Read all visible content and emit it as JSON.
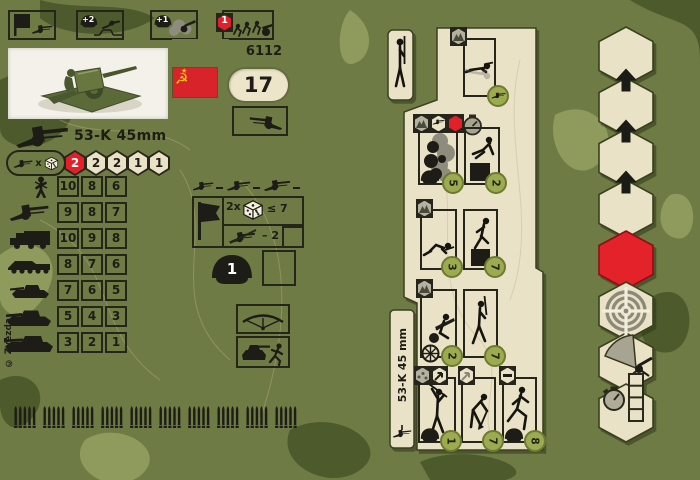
{
  "palette": {
    "camo_base": "#6e7b44",
    "camo_dark": "#4d5a2b",
    "camo_light": "#8f9b5c",
    "card": "#e9e2c6",
    "ink": "#26251c",
    "red": "#e3202a",
    "order_green": "#9cab4f",
    "flag_red": "#d8232a",
    "flag_gold": "#f6c90e"
  },
  "left_card": {
    "code": "6112",
    "points": "17",
    "title": "53-K 45mm",
    "top_icons": [
      {
        "name": "deployment-flag-gun",
        "label": ""
      },
      {
        "name": "infantry-support-bonus",
        "label": "+2"
      },
      {
        "name": "concealment-bonus",
        "label": "+1"
      },
      {
        "name": "crew-relocate",
        "cost": "1"
      }
    ],
    "attack": {
      "times_label": "x",
      "dice": [
        "2",
        "2",
        "2",
        "1",
        "1"
      ]
    },
    "stats": {
      "rows": [
        {
          "target": "infantry",
          "values": [
            "10",
            "8",
            "6"
          ]
        },
        {
          "target": "anti-tank-gun",
          "values": [
            "9",
            "8",
            "7"
          ]
        },
        {
          "target": "truck",
          "values": [
            "10",
            "9",
            "8"
          ]
        },
        {
          "target": "halftrack",
          "values": [
            "8",
            "7",
            "6"
          ]
        },
        {
          "target": "light-tank",
          "values": [
            "7",
            "6",
            "5"
          ]
        },
        {
          "target": "medium-tank",
          "values": [
            "5",
            "4",
            "3"
          ]
        },
        {
          "target": "heavy-tank",
          "values": [
            "3",
            "2",
            "1"
          ]
        }
      ]
    },
    "morale": {
      "multiplier": "2x",
      "threshold": "≤ 7",
      "modifier": "– 2"
    },
    "crew_value": "1",
    "copyright": "© Zvezda"
  },
  "right_card": {
    "vertical_title": "53-K 45 mm",
    "orders": [
      {
        "name": "ambush-prone",
        "cost": ""
      },
      {
        "name": "smoke-screen",
        "cost": "5"
      },
      {
        "name": "assault-over-obstacle",
        "cost": "2"
      },
      {
        "name": "crawl",
        "cost": "3"
      },
      {
        "name": "climb-obstacle",
        "cost": "7"
      },
      {
        "name": "crew-the-gun",
        "cost": "2"
      },
      {
        "name": "march",
        "cost": "7"
      },
      {
        "name": "stand-and-fire",
        "cost": "1"
      },
      {
        "name": "entrench",
        "cost": "7"
      },
      {
        "name": "run",
        "cost": "8"
      }
    ]
  },
  "hex_strip": {
    "cells": [
      "blank",
      "advance-arrow",
      "advance-arrow",
      "advance-arrow",
      "red-stop",
      "target",
      "fire-arc",
      "timer-track"
    ]
  }
}
